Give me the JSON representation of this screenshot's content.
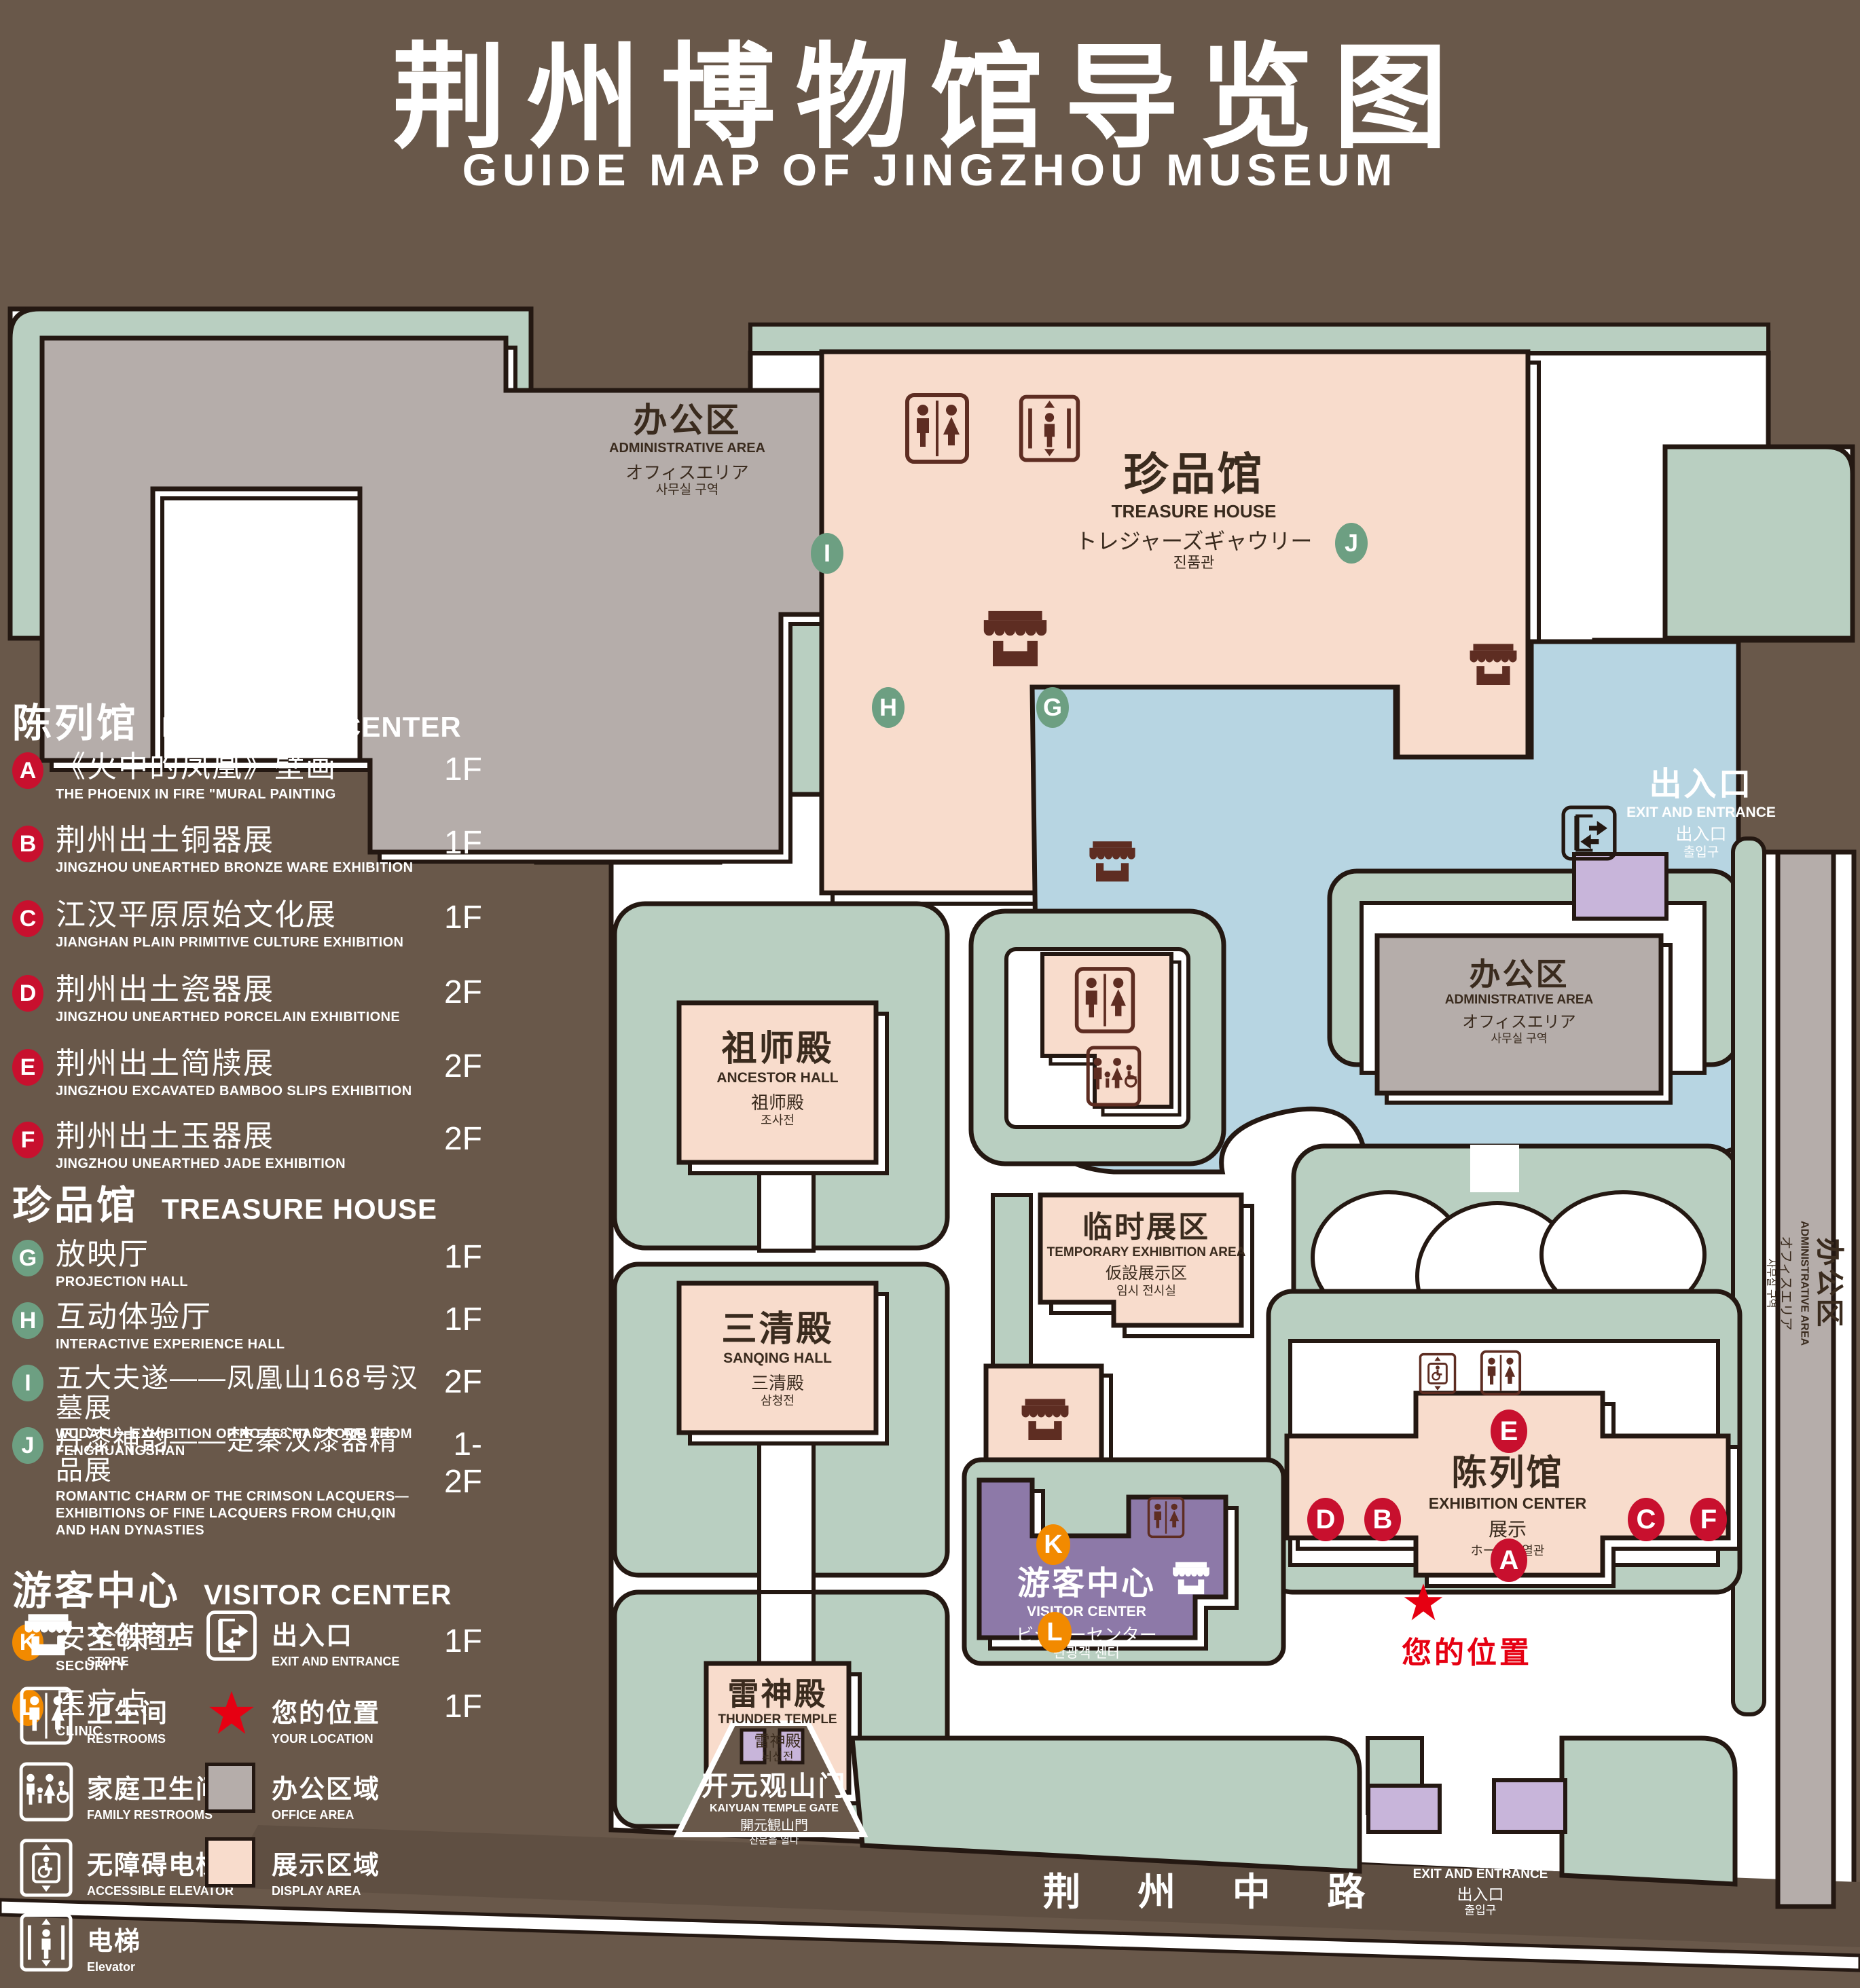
{
  "title": {
    "cn": "荆州博物馆导览图",
    "en": "GUIDE MAP OF JINGZHOU MUSEUM"
  },
  "colors": {
    "background": "#69584a",
    "green_area": "#b9cfc1",
    "display_area_pink": "#f8dccc",
    "office_gray": "#b5adaa",
    "water_blue": "#b7d5e2",
    "visitor_purple": "#8d79a8",
    "gate_purple": "#c8b5da",
    "marker_red": "#c8102e",
    "marker_green": "#6d9f82",
    "marker_orange": "#f28a00",
    "icon_brown": "#5e2d22",
    "location_red": "#e60012",
    "outline": "#241812"
  },
  "legend": {
    "sections": [
      {
        "title_cn": "陈列馆",
        "title_en": "EXHIBITION CENTER",
        "items": [
          {
            "id": "A",
            "cn": "《火中的凤凰》壁画",
            "en": "THE PHOENIX IN FIRE \"MURAL PAINTING",
            "floor": "1F"
          },
          {
            "id": "B",
            "cn": "荆州出土铜器展",
            "en": "JINGZHOU UNEARTHED BRONZE WARE EXHIBITION",
            "floor": "1F"
          },
          {
            "id": "C",
            "cn": "江汉平原原始文化展",
            "en": "JIANGHAN PLAIN PRIMITIVE CULTURE EXHIBITION",
            "floor": "1F"
          },
          {
            "id": "D",
            "cn": "荆州出土瓷器展",
            "en": "JINGZHOU UNEARTHED PORCELAIN EXHIBITIONE",
            "floor": "2F"
          },
          {
            "id": "E",
            "cn": "荆州出土简牍展",
            "en": "JINGZHOU EXCAVATED BAMBOO SLIPS EXHIBITION",
            "floor": "2F"
          },
          {
            "id": "F",
            "cn": "荆州出土玉器展",
            "en": "JINGZHOU UNEARTHED JADE EXHIBITION",
            "floor": "2F"
          }
        ]
      },
      {
        "title_cn": "珍品馆",
        "title_en": "TREASURE HOUSE",
        "items": [
          {
            "id": "G",
            "cn": "放映厅",
            "en": "PROJECTION HALL",
            "floor": "1F"
          },
          {
            "id": "H",
            "cn": "互动体验厅",
            "en": "INTERACTIVE EXPERIENCE HALL",
            "floor": "1F"
          },
          {
            "id": "I",
            "cn": "五大夫遂——凤凰山168号汉墓展",
            "en": "WUDAFU—EXHIBITION OF NO.168 HAN TOMB FROM FENGHUANGSHAN",
            "floor": "2F"
          },
          {
            "id": "J",
            "cn": "丹漆神韵——楚秦汉漆器精品展",
            "en": "ROMANTIC CHARM OF THE CRIMSON LACQUERS—EXHIBITIONS OF FINE LACQUERS FROM CHU,QIN AND HAN DYNASTIES",
            "floor": "1-2F"
          }
        ]
      },
      {
        "title_cn": "游客中心",
        "title_en": "VISITOR CENTER",
        "items": [
          {
            "id": "K",
            "cn": "安全保卫",
            "en": "SECURITY",
            "floor": "1F"
          },
          {
            "id": "L",
            "cn": "医疗点",
            "en": "CLINIC",
            "floor": "1F"
          }
        ]
      }
    ],
    "symbols": [
      {
        "cn": "文创商店",
        "en": "STORE"
      },
      {
        "cn": "卫生间",
        "en": "RESTROOMS"
      },
      {
        "cn": "家庭卫生间",
        "en": "FAMILY RESTROOMS"
      },
      {
        "cn": "无障碍电梯",
        "en": "ACCESSIBLE  ELEVATOR"
      },
      {
        "cn": "电梯",
        "en": "Elevator"
      }
    ],
    "swatches": [
      {
        "cn": "出入口",
        "en": "EXIT AND ENTRANCE"
      },
      {
        "cn": "您的位置",
        "en": "YOUR LOCATION"
      },
      {
        "cn": "办公区域",
        "en": "OFFICE AREA",
        "color": "#b5adaa"
      },
      {
        "cn": "展示区域",
        "en": "DISPLAY AREA",
        "color": "#f8dccc"
      }
    ]
  },
  "map": {
    "labels": {
      "admin_top_left": {
        "cn": "办公区",
        "en": "ADMINISTRATIVE AREA",
        "jp": "オフィスエリア",
        "kr": "사무실 구역"
      },
      "treasure_house": {
        "cn": "珍品馆",
        "en": "TREASURE HOUSE",
        "jp": "トレジャーズギャウリー",
        "kr": "진품관"
      },
      "ancestor_hall": {
        "cn": "祖师殿",
        "en": "ANCESTOR HALL",
        "jp": "祖师殿",
        "kr": "조사전"
      },
      "sanqing_hall": {
        "cn": "三清殿",
        "en": "SANQING HALL",
        "jp": "三清殿",
        "kr": "삼청전"
      },
      "thunder_temple": {
        "cn": "雷神殿",
        "en": "THUNDER TEMPLE",
        "jp": "雷神殿",
        "kr": "뇌신전"
      },
      "temporary_area": {
        "cn": "临时展区",
        "en": "TEMPORARY EXHIBITION AREA",
        "jp": "仮設展示区",
        "kr": "임시 전시실"
      },
      "admin_right": {
        "cn": "办公区",
        "en": "ADMINISTRATIVE AREA",
        "jp": "オフィスエリア",
        "kr": "사무실 구역"
      },
      "admin_strip": {
        "cn": "办公区",
        "en": "ADMINISTRATIVE AREA",
        "jp": "オフィスエリア",
        "kr": "사무실 구역"
      },
      "visitor_center": {
        "cn": "游客中心",
        "en": "VISITOR CENTER",
        "jp": "ビジターセンター",
        "kr": "관광객 센터"
      },
      "exhibition_center": {
        "cn": "陈列馆",
        "en": "EXHIBITION CENTER",
        "jp": "展示",
        "kr": "ホール  진열관"
      },
      "exit_right": {
        "cn": "出入口",
        "en": "EXIT AND ENTRANCE",
        "jp": "出入口",
        "kr": "출입구"
      },
      "exit_bottom": {
        "cn": "出入口",
        "en": "EXIT AND ENTRANCE",
        "jp": "出入口",
        "kr": "출입구"
      },
      "gate": {
        "cn": "开元观山门",
        "en": "KAIYUAN TEMPLE GATE",
        "jp": "開元観山門",
        "kr": "산문을 열다"
      },
      "road": "荆 州 中 路",
      "your_location": "您的位置"
    },
    "markers": {
      "A": "A",
      "B": "B",
      "C": "C",
      "D": "D",
      "E": "E",
      "F": "F",
      "G": "G",
      "H": "H",
      "I": "I",
      "J": "J",
      "K": "K",
      "L": "L"
    }
  }
}
